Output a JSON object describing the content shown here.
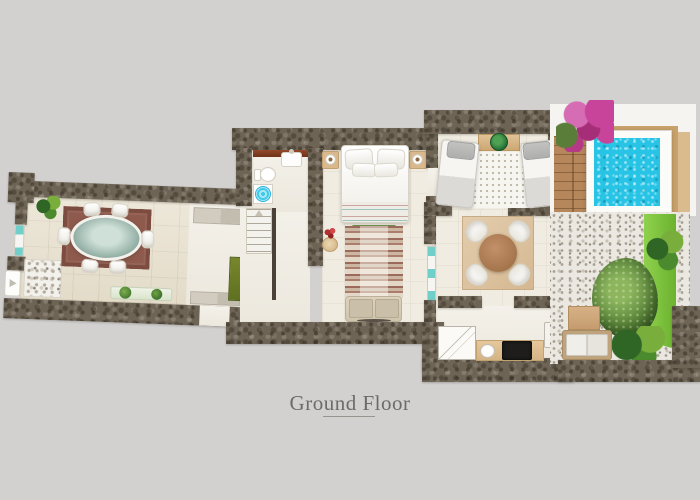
{
  "caption": {
    "title": "Ground Floor"
  },
  "palette": {
    "background": "#d2d1d0",
    "wall_stone": "#6e6455",
    "floor_tile": "#e9e2d1",
    "floor_light": "#f0ece1",
    "pool_water": "#27c4e6",
    "grass": "#7cc33e",
    "dining_rug": "#8d5a4d",
    "wood_deck": "#b5875a",
    "window_accent": "#71cfc9",
    "bougainvillea": "#c8439a"
  },
  "floorplan": {
    "rooms": [
      {
        "name": "dining-room",
        "features": [
          "oval-glass-table",
          "six-chairs",
          "red-area-rug",
          "corner-plant",
          "pebble-mat",
          "plant-bench",
          "entrance-door"
        ]
      },
      {
        "name": "hallway",
        "features": [
          "sideboards",
          "green-door"
        ]
      },
      {
        "name": "bathroom",
        "features": [
          "vanity-shelf",
          "washbasin",
          "toilet",
          "washing-machine"
        ]
      },
      {
        "name": "staircase",
        "features": [
          "stairs-up",
          "handrail"
        ]
      },
      {
        "name": "master-bedroom",
        "features": [
          "double-bed",
          "two-nightstands",
          "table-lamps",
          "green-bench",
          "kilim-rug",
          "flower-side-table",
          "sofa"
        ]
      },
      {
        "name": "twin-bedroom",
        "features": [
          "two-single-beds",
          "console-table",
          "potted-plant",
          "dotted-rug"
        ]
      },
      {
        "name": "living-area",
        "features": [
          "round-dining-table",
          "four-chairs",
          "square-rug"
        ]
      },
      {
        "name": "kitchen",
        "features": [
          "corner-shower",
          "counter",
          "kitchen-sink",
          "cooktop",
          "fridge"
        ]
      },
      {
        "name": "pool-terrace",
        "features": [
          "plunge-pool",
          "wood-deck",
          "bougainvillea",
          "gravel-ground",
          "large-tree",
          "grass-border",
          "palm-plants",
          "door-mat",
          "outdoor-bench"
        ]
      }
    ]
  }
}
